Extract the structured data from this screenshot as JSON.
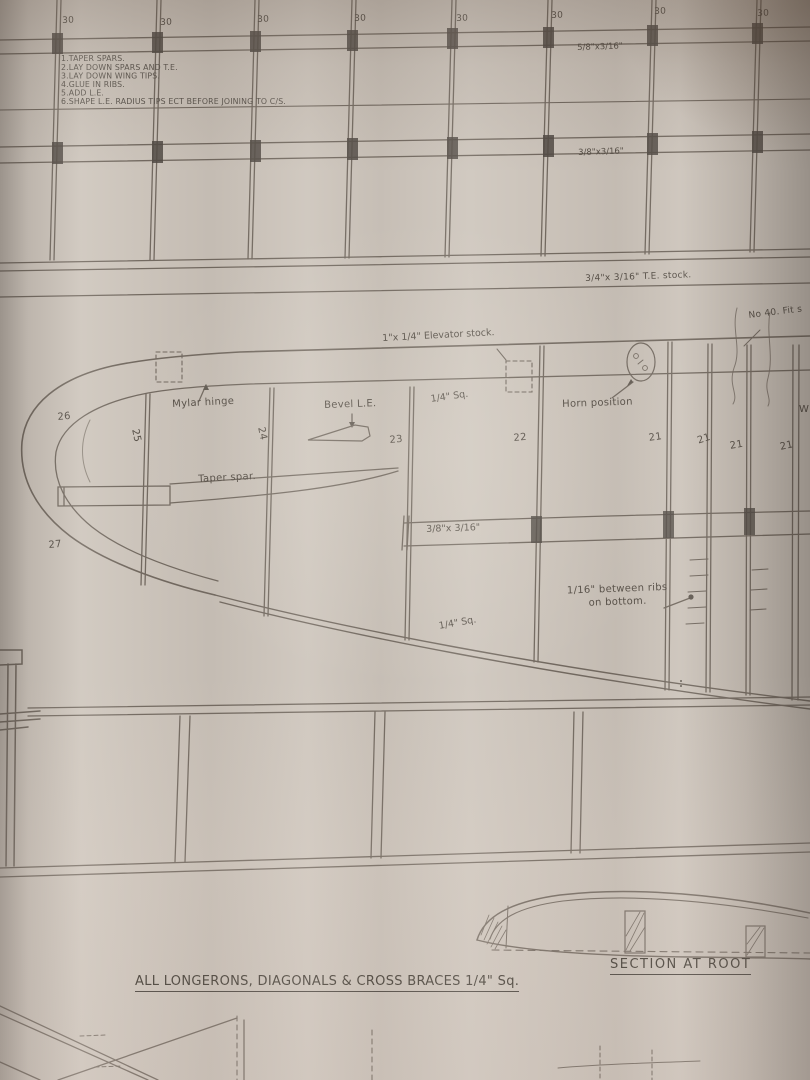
{
  "wing_top": {
    "rib_labels": [
      "30",
      "30",
      "30",
      "30",
      "30",
      "30",
      "30",
      "30"
    ],
    "instructions": [
      "1.TAPER SPARS.",
      "2.LAY DOWN SPARS AND T.E.",
      "3.LAY DOWN WING TIPS.",
      "4.GLUE IN RIBS.",
      "5.ADD L.E.",
      "6.SHAPE L.E. RADIUS TIPS ECT BEFORE JOINING TO C/S."
    ],
    "spar_upper_label": "5/8\"x3/16\"",
    "spar_lower_label": "3/8\"x3/16\"",
    "te_label": "3/4\"x 3/16\" T.E. stock."
  },
  "elevator": {
    "fit_note": "No 40. Fit s",
    "stock_label": "1\"x 1/4\" Elevator stock.",
    "mylar_hinge_label": "Mylar hinge",
    "bevel_le_label": "Bevel L.E.",
    "quarter_sq_top": "1/4\" Sq.",
    "horn_position_label": "Horn position",
    "edge_partial": "W",
    "rib_numbers": [
      "26",
      "25",
      "24",
      "23",
      "22",
      "21",
      "21",
      "21",
      "21"
    ],
    "taper_spar_label": "Taper spar.",
    "spar_label": "3/8\"x 3/16\"",
    "rib_27": "27",
    "ribs_note_line1": "1/16\" between ribs",
    "ribs_note_line2": "on bottom.",
    "quarter_sq_bottom": "1/4\" Sq."
  },
  "section_view": {
    "title": "SECTION AT ROOT"
  },
  "notes": {
    "longerons": "ALL LONGERONS, DIAGONALS & CROSS BRACES 1/4\" Sq."
  }
}
